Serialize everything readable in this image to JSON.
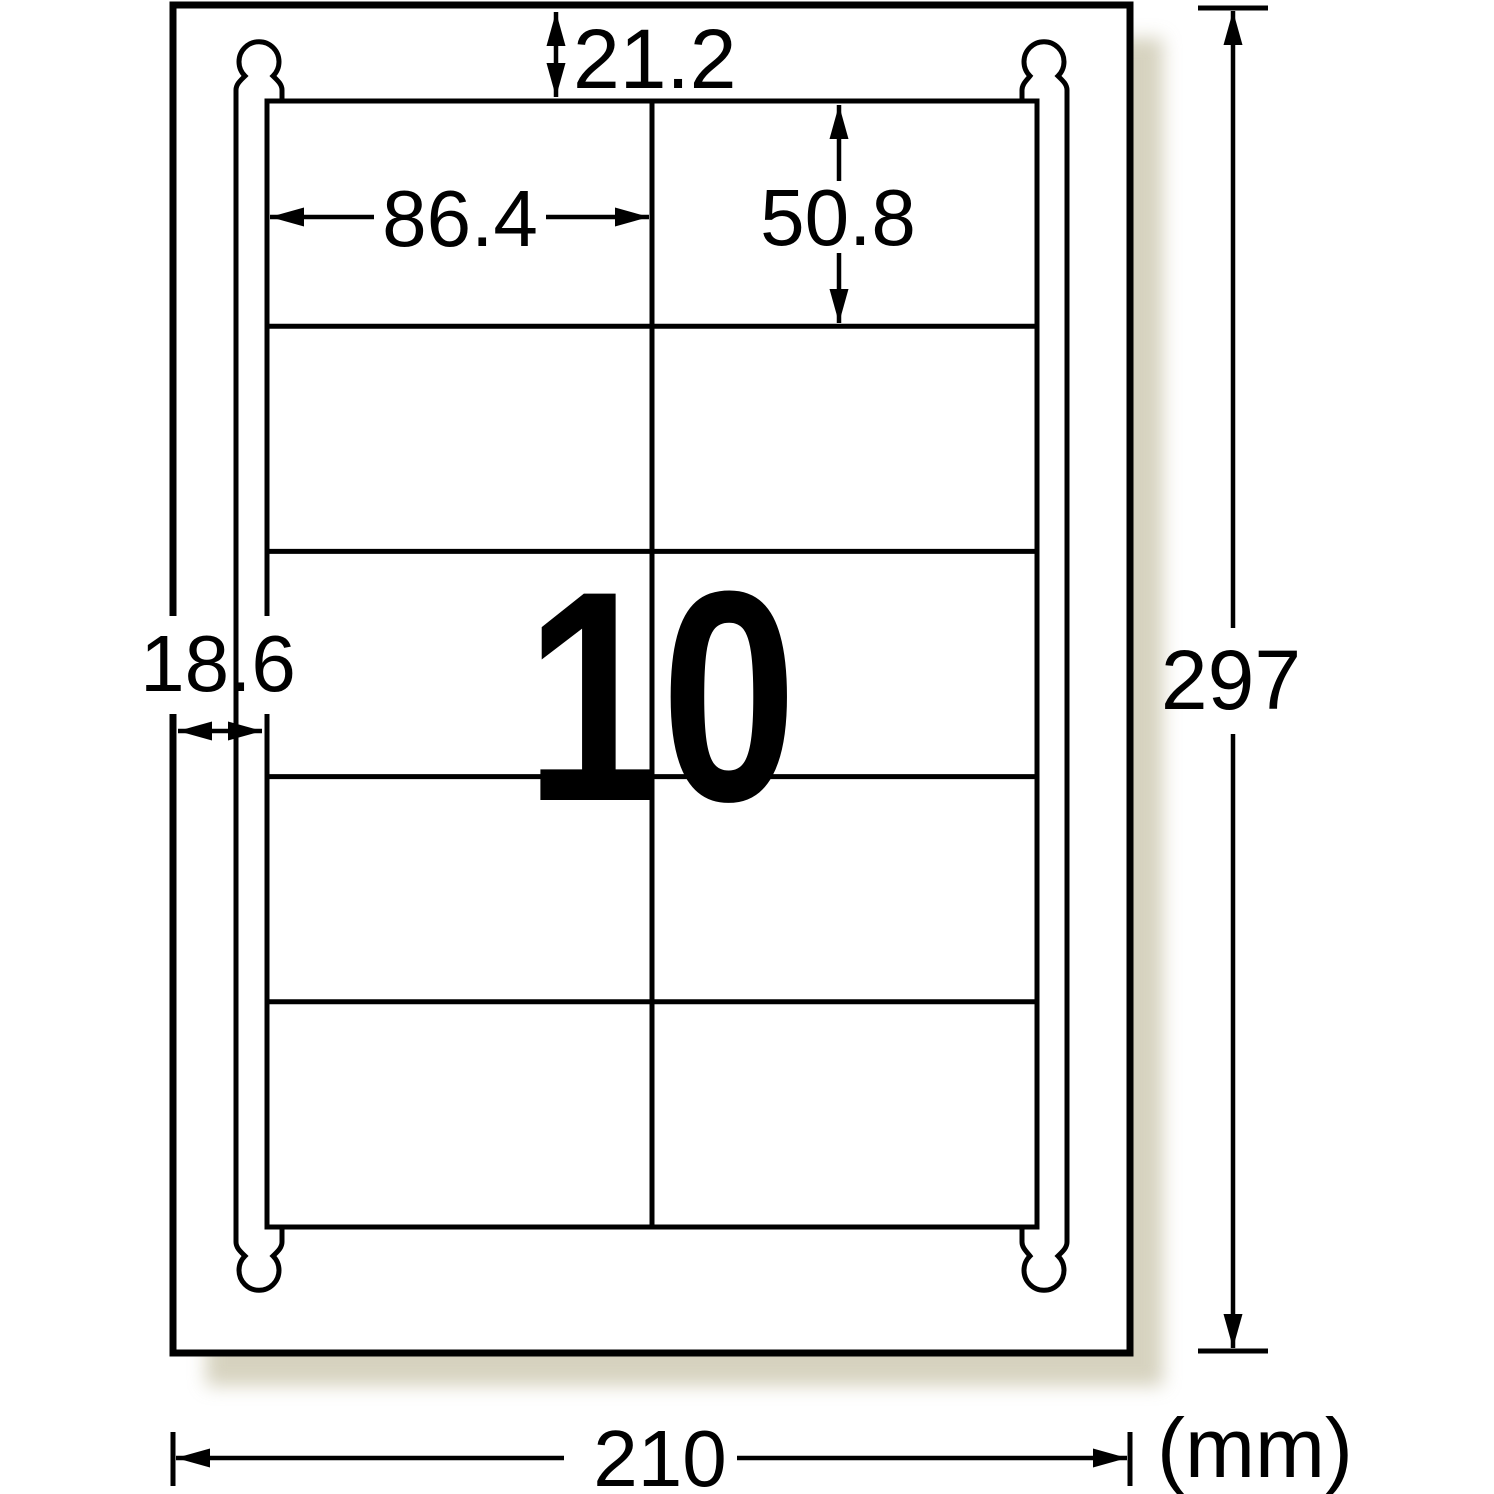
{
  "diagram_title": "label-sheet-dimension-diagram",
  "unit_label": "(mm)",
  "labels_per_sheet": "10",
  "dimensions": {
    "top_margin": "21.2",
    "label_width": "86.4",
    "label_height": "50.8",
    "side_margin": "18.6",
    "sheet_height": "297",
    "sheet_width": "210"
  },
  "grid": {
    "rows": 5,
    "columns": 2
  },
  "colors": {
    "count_pink": "#F6B1D5",
    "line_black": "#000000",
    "shadow_beige": "#c9c4aa"
  }
}
